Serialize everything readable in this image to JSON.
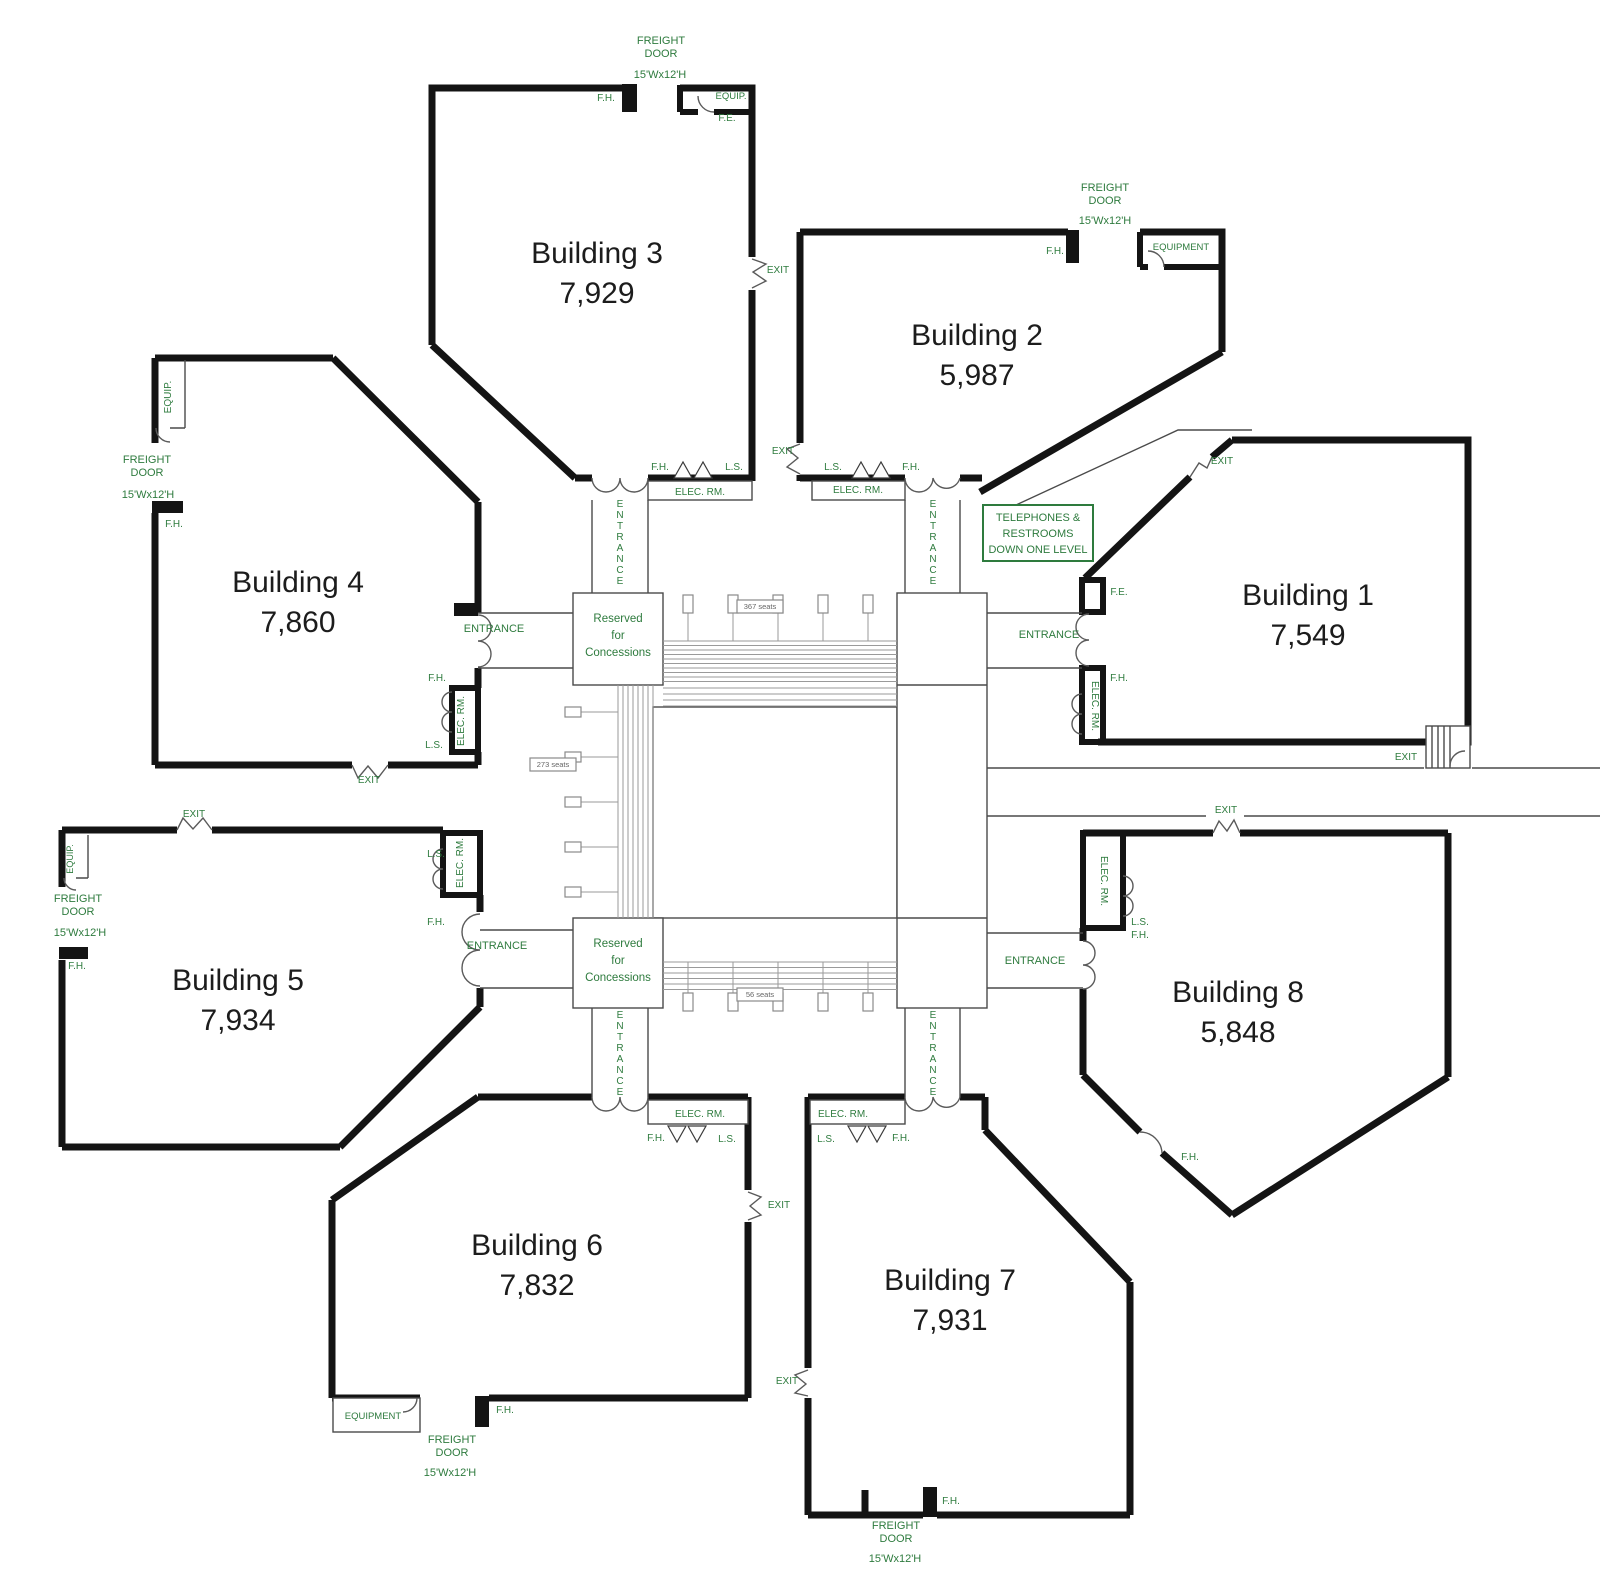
{
  "title": "Eight-building exposition complex floor plan",
  "buildings": [
    {
      "id": "building-3",
      "name": "Building 3",
      "area": "7,929",
      "x": 597,
      "y": 263
    },
    {
      "id": "building-2",
      "name": "Building 2",
      "area": "5,987",
      "x": 977,
      "y": 345
    },
    {
      "id": "building-1",
      "name": "Building 1",
      "area": "7,549",
      "x": 1308,
      "y": 605
    },
    {
      "id": "building-4",
      "name": "Building 4",
      "area": "7,860",
      "x": 298,
      "y": 592
    },
    {
      "id": "building-5",
      "name": "Building 5",
      "area": "7,934",
      "x": 238,
      "y": 990
    },
    {
      "id": "building-6",
      "name": "Building 6",
      "area": "7,832",
      "x": 537,
      "y": 1255
    },
    {
      "id": "building-7",
      "name": "Building 7",
      "area": "7,931",
      "x": 950,
      "y": 1290
    },
    {
      "id": "building-8",
      "name": "Building 8",
      "area": "5,848",
      "x": 1238,
      "y": 1002
    }
  ],
  "notice": {
    "lines": [
      "TELEPHONES &",
      "RESTROOMS",
      "DOWN ONE LEVEL"
    ]
  },
  "concessions": {
    "lines": [
      "Reserved",
      "for",
      "Concessions"
    ]
  },
  "concession_boxes": [
    {
      "x": 618,
      "y": 622
    },
    {
      "x": 618,
      "y": 947
    }
  ],
  "entrance_stacks": [
    {
      "n": "building-3-entrance",
      "t": "ENTRANCE",
      "x": 620,
      "y": 507,
      "lh": 11
    },
    {
      "n": "building-2-entrance",
      "t": "ENTRANCE",
      "x": 933,
      "y": 507,
      "lh": 11
    },
    {
      "n": "building-6-entrance",
      "t": "ENTRANCE",
      "x": 620,
      "y": 1018,
      "lh": 11
    },
    {
      "n": "building-7-entrance",
      "t": "ENTRANCE",
      "x": 933,
      "y": 1018,
      "lh": 11
    }
  ],
  "seat_labels": [
    {
      "n": "seat-count-top",
      "t": "367 seats",
      "x": 760,
      "y": 609
    },
    {
      "n": "seat-count-left",
      "t": "273 seats",
      "x": 553,
      "y": 767
    },
    {
      "n": "seat-count-bottom",
      "t": "56 seats",
      "x": 760,
      "y": 997
    }
  ],
  "annotations": [
    {
      "n": "b3-freight-door-1",
      "t": "FREIGHT",
      "x": 661,
      "y": 44
    },
    {
      "n": "b3-freight-door-2",
      "t": "DOOR",
      "x": 661,
      "y": 57
    },
    {
      "n": "b3-freight-size",
      "t": "15'Wx12'H",
      "x": 660,
      "y": 78
    },
    {
      "n": "b3-fh-top",
      "t": "F.H.",
      "x": 606,
      "y": 101,
      "s": 10
    },
    {
      "n": "b3-equip",
      "t": "EQUIP.",
      "x": 731,
      "y": 99,
      "s": 9.5
    },
    {
      "n": "b3-fe",
      "t": "F.E.",
      "x": 727,
      "y": 121,
      "s": 10
    },
    {
      "n": "b3-exit",
      "t": "EXIT",
      "x": 778,
      "y": 273,
      "s": 10
    },
    {
      "n": "b3-fh",
      "t": "F.H.",
      "x": 660,
      "y": 470,
      "s": 10
    },
    {
      "n": "b3-ls",
      "t": "L.S.",
      "x": 734,
      "y": 470,
      "s": 10
    },
    {
      "n": "b3-elec-rm",
      "t": "ELEC. RM.",
      "x": 700,
      "y": 495,
      "s": 10
    },
    {
      "n": "b2-freight-door-1",
      "t": "FREIGHT",
      "x": 1105,
      "y": 191
    },
    {
      "n": "b2-freight-door-2",
      "t": "DOOR",
      "x": 1105,
      "y": 204
    },
    {
      "n": "b2-freight-size",
      "t": "15'Wx12'H",
      "x": 1105,
      "y": 224
    },
    {
      "n": "b2-fh-top",
      "t": "F.H.",
      "x": 1055,
      "y": 254,
      "s": 10
    },
    {
      "n": "b2-equipment",
      "t": "EQUIPMENT",
      "x": 1181,
      "y": 250,
      "s": 9.5
    },
    {
      "n": "b2-exit",
      "t": "EXIT",
      "x": 783,
      "y": 454,
      "s": 10
    },
    {
      "n": "b2-ls",
      "t": "L.S.",
      "x": 833,
      "y": 470,
      "s": 10
    },
    {
      "n": "b2-fh",
      "t": "F.H.",
      "x": 911,
      "y": 470,
      "s": 10
    },
    {
      "n": "b2-elec-rm",
      "t": "ELEC. RM.",
      "x": 858,
      "y": 493,
      "s": 10
    },
    {
      "n": "b1-exit-top",
      "t": "EXIT",
      "x": 1222,
      "y": 464,
      "s": 10
    },
    {
      "n": "b1-fe",
      "t": "F.E.",
      "x": 1119,
      "y": 595,
      "s": 10
    },
    {
      "n": "b1-entrance",
      "t": "ENTRANCE",
      "x": 1049,
      "y": 638
    },
    {
      "n": "b1-fh",
      "t": "F.H.",
      "x": 1119,
      "y": 681,
      "s": 10
    },
    {
      "n": "b1-elec-rm",
      "t": "ELEC. RM.",
      "x": 1092,
      "y": 706,
      "r": 90,
      "s": 10
    },
    {
      "n": "b1-exit-bottom",
      "t": "EXIT",
      "x": 1406,
      "y": 760,
      "s": 10
    },
    {
      "n": "b4-equip",
      "t": "EQUIP.",
      "x": 171,
      "y": 397,
      "r": -90,
      "s": 10
    },
    {
      "n": "b4-freight-door-1",
      "t": "FREIGHT",
      "x": 147,
      "y": 463
    },
    {
      "n": "b4-freight-door-2",
      "t": "DOOR",
      "x": 147,
      "y": 476
    },
    {
      "n": "b4-freight-size",
      "t": "15'Wx12'H",
      "x": 148,
      "y": 498
    },
    {
      "n": "b4-fh-top",
      "t": "F.H.",
      "x": 174,
      "y": 527,
      "s": 10
    },
    {
      "n": "b4-entrance",
      "t": "ENTRANCE",
      "x": 494,
      "y": 632
    },
    {
      "n": "b4-fh",
      "t": "F.H.",
      "x": 437,
      "y": 681,
      "s": 10
    },
    {
      "n": "b4-elec-rm",
      "t": "ELEC. RM.",
      "x": 464,
      "y": 721,
      "r": -90,
      "s": 10
    },
    {
      "n": "b4-ls",
      "t": "L.S.",
      "x": 434,
      "y": 748,
      "s": 10
    },
    {
      "n": "b4-exit",
      "t": "EXIT",
      "x": 369,
      "y": 783,
      "s": 10
    },
    {
      "n": "b5-exit",
      "t": "EXIT",
      "x": 194,
      "y": 817,
      "s": 10
    },
    {
      "n": "b5-equip",
      "t": "EQUIP.",
      "x": 73,
      "y": 859,
      "r": -90,
      "s": 9
    },
    {
      "n": "b5-freight-door-1",
      "t": "FREIGHT",
      "x": 78,
      "y": 902
    },
    {
      "n": "b5-freight-door-2",
      "t": "DOOR",
      "x": 78,
      "y": 915
    },
    {
      "n": "b5-freight-size",
      "t": "15'Wx12'H",
      "x": 80,
      "y": 936
    },
    {
      "n": "b5-fh-top",
      "t": "F.H.",
      "x": 77,
      "y": 969,
      "s": 10
    },
    {
      "n": "b5-ls",
      "t": "L.S.",
      "x": 436,
      "y": 857,
      "s": 10
    },
    {
      "n": "b5-elec-rm",
      "t": "ELEC. RM.",
      "x": 463,
      "y": 863,
      "r": -90,
      "s": 10
    },
    {
      "n": "b5-fh",
      "t": "F.H.",
      "x": 436,
      "y": 925,
      "s": 10
    },
    {
      "n": "b5-entrance",
      "t": "ENTRANCE",
      "x": 497,
      "y": 949
    },
    {
      "n": "b8-exit",
      "t": "EXIT",
      "x": 1226,
      "y": 813,
      "s": 10
    },
    {
      "n": "b8-elec-rm",
      "t": "ELEC. RM.",
      "x": 1101,
      "y": 881,
      "r": 90,
      "s": 10
    },
    {
      "n": "b8-ls",
      "t": "L.S.",
      "x": 1140,
      "y": 925,
      "s": 10
    },
    {
      "n": "b8-fh",
      "t": "F.H.",
      "x": 1140,
      "y": 938,
      "s": 10
    },
    {
      "n": "b8-entrance",
      "t": "ENTRANCE",
      "x": 1035,
      "y": 964
    },
    {
      "n": "b8-fh-diag",
      "t": "F.H.",
      "x": 1190,
      "y": 1160,
      "s": 10
    },
    {
      "n": "b6-elec-rm",
      "t": "ELEC. RM.",
      "x": 700,
      "y": 1117,
      "s": 10
    },
    {
      "n": "b6-fh",
      "t": "F.H.",
      "x": 656,
      "y": 1141,
      "s": 10
    },
    {
      "n": "b6-ls",
      "t": "L.S.",
      "x": 727,
      "y": 1142,
      "s": 10
    },
    {
      "n": "b6-exit",
      "t": "EXIT",
      "x": 779,
      "y": 1208,
      "s": 10
    },
    {
      "n": "b6-equipment",
      "t": "EQUIPMENT",
      "x": 373,
      "y": 1419,
      "s": 9.5
    },
    {
      "n": "b6-fh-bottom",
      "t": "F.H.",
      "x": 505,
      "y": 1413,
      "s": 10
    },
    {
      "n": "b6-freight-door-1",
      "t": "FREIGHT",
      "x": 452,
      "y": 1443
    },
    {
      "n": "b6-freight-door-2",
      "t": "DOOR",
      "x": 452,
      "y": 1456
    },
    {
      "n": "b6-freight-size",
      "t": "15'Wx12'H",
      "x": 450,
      "y": 1476
    },
    {
      "n": "b7-elec-rm",
      "t": "ELEC. RM.",
      "x": 843,
      "y": 1117,
      "s": 10
    },
    {
      "n": "b7-ls",
      "t": "L.S.",
      "x": 826,
      "y": 1142,
      "s": 10
    },
    {
      "n": "b7-fh",
      "t": "F.H.",
      "x": 901,
      "y": 1141,
      "s": 10
    },
    {
      "n": "b7-exit",
      "t": "EXIT",
      "x": 787,
      "y": 1384,
      "s": 10
    },
    {
      "n": "b7-fh-bottom",
      "t": "F.H.",
      "x": 951,
      "y": 1504,
      "s": 10
    },
    {
      "n": "b7-freight-door-1",
      "t": "FREIGHT",
      "x": 896,
      "y": 1529
    },
    {
      "n": "b7-freight-door-2",
      "t": "DOOR",
      "x": 896,
      "y": 1542
    },
    {
      "n": "b7-freight-size",
      "t": "15'Wx12'H",
      "x": 895,
      "y": 1562
    }
  ],
  "colors": {
    "wall": "#141414",
    "label_green": "#2e7b3e",
    "building_text": "#1c1c1c",
    "queue_gray": "#9a9a9a"
  }
}
